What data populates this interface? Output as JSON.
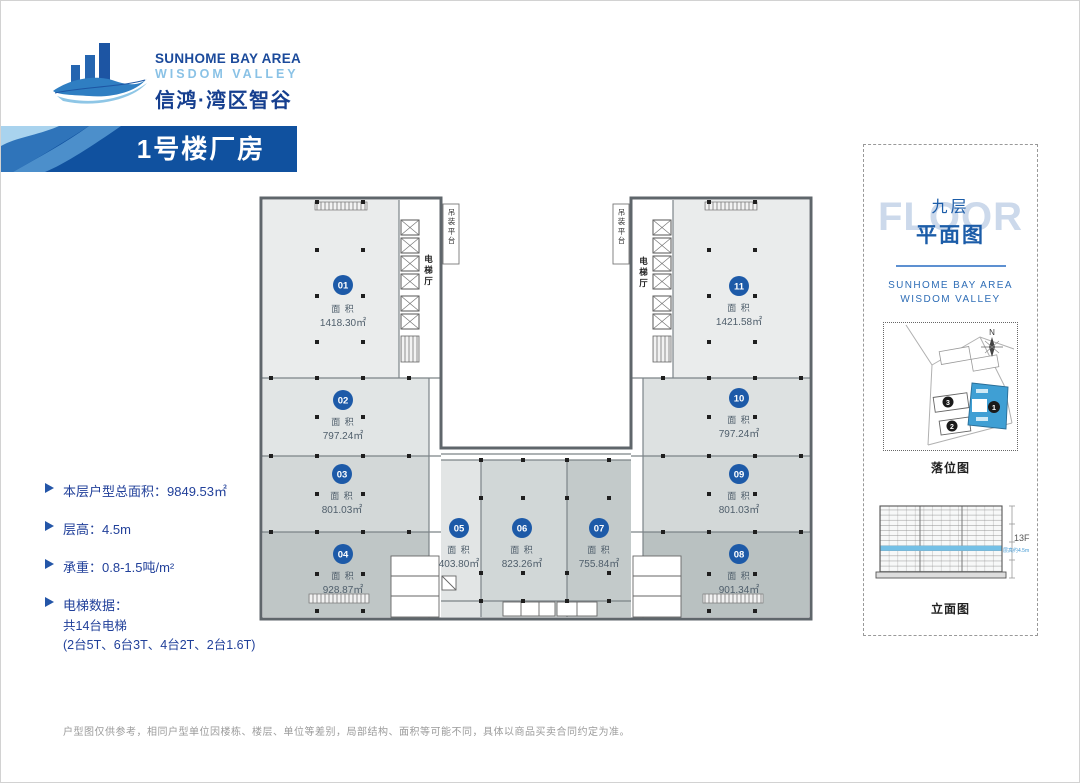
{
  "logo": {
    "line1": "SUNHOME BAY AREA",
    "line2": "WISDOM VALLEY",
    "line3": "信鸿·湾区智谷"
  },
  "banner": {
    "title": "1号楼厂房"
  },
  "plan": {
    "area_label": "面 积",
    "units": [
      {
        "num": "01",
        "area": "1418.30㎡"
      },
      {
        "num": "02",
        "area": "797.24㎡"
      },
      {
        "num": "03",
        "area": "801.03㎡"
      },
      {
        "num": "04",
        "area": "928.87㎡"
      },
      {
        "num": "05",
        "area": "403.80㎡"
      },
      {
        "num": "06",
        "area": "823.26㎡"
      },
      {
        "num": "07",
        "area": "755.84㎡"
      },
      {
        "num": "08",
        "area": "901.34㎡"
      },
      {
        "num": "09",
        "area": "801.03㎡"
      },
      {
        "num": "10",
        "area": "797.24㎡"
      },
      {
        "num": "11",
        "area": "1421.58㎡"
      }
    ],
    "labels": {
      "elevator_hall": "电梯厅",
      "hoist_platform": "吊装平台"
    }
  },
  "info": {
    "items": [
      {
        "label": "本层户型总面积：9849.53㎡"
      },
      {
        "label": "层高：4.5m"
      },
      {
        "label": "承重：0.8-1.5吨/m²"
      },
      {
        "label": "电梯数据：",
        "sub1": "共14台电梯",
        "sub2": "(2台5T、6台3T、4台2T、2台1.6T)"
      }
    ]
  },
  "panel": {
    "floor_bg": "FLOOR",
    "floor_cn": "九层",
    "plan_cn": "平面图",
    "brand1": "SUNHOME BAY AREA",
    "brand2": "WISDOM VALLEY",
    "map_caption": "落位图",
    "elev_caption": "立面图",
    "compass": "N",
    "map_badges": {
      "b1": "1",
      "b2": "2",
      "b3": "3"
    },
    "elev_floor": "13F",
    "elev_height": "层高约4.5m"
  },
  "disclaimer": "户型图仅供参考，相同户型单位因楼栋、楼层、单位等差别，局部结构、面积等可能不同，具体以商品买卖合同约定为准。",
  "colors": {
    "banner_blue": "#10519f",
    "badge_blue": "#1d5aa8",
    "accent_blue": "#1b5ca8",
    "highlight_building": "#3f9fd4",
    "elev_band": "#74c0e6"
  }
}
